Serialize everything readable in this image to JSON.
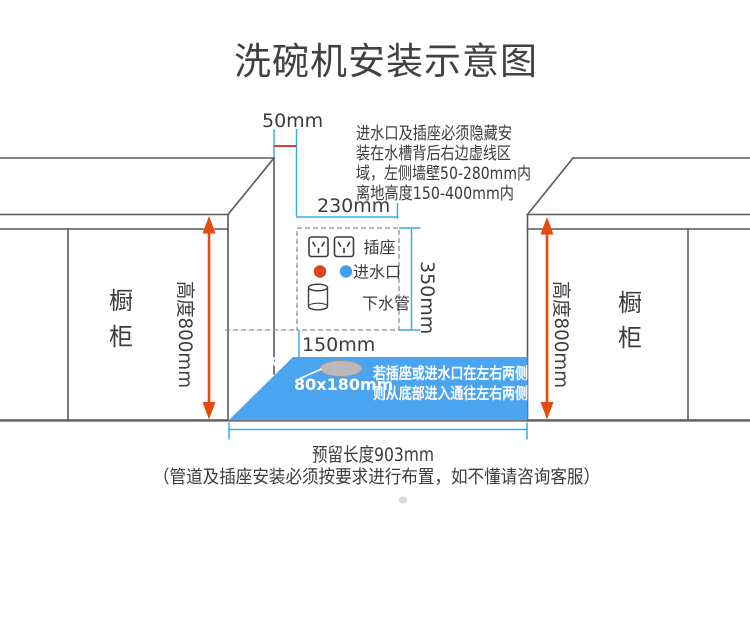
{
  "title": "洗碗机安装示意图",
  "install_note": {
    "lines": [
      "进水口及插座必须隐藏安",
      "装在水槽背后右边虚线区",
      "域，左侧墙壁50-280mm内",
      "离地高度150-400mm内"
    ]
  },
  "left_cabinet": {
    "label_top": "橱",
    "label_bottom": "柜",
    "height_label": "高度800mm"
  },
  "right_cabinet": {
    "label_top": "橱",
    "label_bottom": "柜",
    "height_label": "高度800mm"
  },
  "hidden_zone": {
    "socket_label": "插座",
    "water_inlet_label": "进水口",
    "drain_pipe_label": "下水管"
  },
  "dimensions": {
    "wall_gap": "50mm",
    "zone_width": "230mm",
    "zone_height": "350mm",
    "floor_gap": "150mm",
    "floor_depth": "600mm",
    "hole_size": "80x180mm",
    "reserved_length": "预留长度903mm"
  },
  "floor_note": {
    "line1": "若插座或进水口在左右两侧",
    "line2": "则从底部进入通往左右两侧"
  },
  "footer_note": "（管道及插座安装必须按要求进行布置，如不懂请咨询客服）",
  "icons": {
    "socket": "socket-outlet-icon",
    "water_inlet": "colored-dot-icon",
    "drain_pipe": "cylinder-pipe-icon"
  },
  "colors": {
    "outline_gray": "#58595d",
    "dimension_blue": "#37aee4",
    "measure_red": "#e23936",
    "height_arrow_orange": "#e8490e",
    "floor_blue": "#4aa4f0",
    "water_inlet_red": "#dc4517",
    "water_inlet_blue": "#42a0e8"
  }
}
